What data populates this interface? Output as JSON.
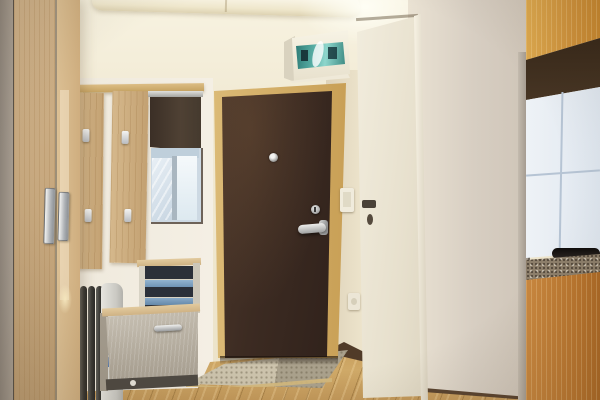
{
  "scene": {
    "description": "Photograph of an apartment entry hallway: dark brown front door with golden wood frame, white fuse box with teal window above left of it, cream interior door on the right, beige walls, kitchenette with orange wood cabinets, dark range hood, white tile backsplash and speckled countertop at far right, light oak wardrobe at far left, wall coat rack boards with metal hooks, cabinet mirror with dark roller blind, small open shelf unit, light grey shoe cabinet, black-and-white oil heater, oak laminate floor with stone threshold mat in front of the door",
    "objects": [
      {
        "name": "front-door",
        "material": "dark brown steel",
        "color": "#3c2b22"
      },
      {
        "name": "front-door-frame",
        "color": "#cfa963"
      },
      {
        "name": "peephole",
        "color": "#c9c9c7"
      },
      {
        "name": "door-handle",
        "color": "#b9bcc0"
      },
      {
        "name": "fuse-box",
        "color": "#f1ecdc",
        "window_color": "#56aca3"
      },
      {
        "name": "interior-door",
        "color": "#eee8d8",
        "handle_color": "#4a4238"
      },
      {
        "name": "light-switch",
        "color": "#f0ebdc"
      },
      {
        "name": "power-outlet",
        "color": "#ece6d6"
      },
      {
        "name": "wardrobe",
        "color": "#c7a77c"
      },
      {
        "name": "coat-rack-boards",
        "color": "#ccae81"
      },
      {
        "name": "mirror",
        "color": "#dfe9f1",
        "blind_color": "#46392d"
      },
      {
        "name": "shelf-unit",
        "interior_color": "#2b3039",
        "shelf_color": "#82a6c4"
      },
      {
        "name": "shoe-cabinet",
        "color": "#b6aea1"
      },
      {
        "name": "oil-heater",
        "fin_color": "#44433f",
        "panel_color": "#d9d8d2"
      },
      {
        "name": "kitchen-upper-cabinet",
        "color": "#d0953f"
      },
      {
        "name": "range-hood",
        "color": "#3f2e1e"
      },
      {
        "name": "backsplash-tiles",
        "color": "#e9eef4"
      },
      {
        "name": "countertop",
        "color": "#897c6a"
      },
      {
        "name": "kitchen-lower-cabinet",
        "color": "#bf7c36"
      },
      {
        "name": "floor",
        "color": "#cba566"
      },
      {
        "name": "threshold-mat",
        "color": "#c3baa3"
      }
    ]
  },
  "palette": {
    "wall_back": "#efe7cf",
    "wall_left": "#f1ece1",
    "wall_right": "#d9d0c4",
    "ceiling": "#f8f3e1",
    "door_brown": "#3c2b22",
    "door_frame": "#cfa963",
    "white_door": "#eee8d8",
    "white_door_handle": "#4a4238",
    "fuse_teal": "#56aca3",
    "wardrobe_wood": "#c7a77c",
    "coat_board": "#ccae81",
    "blind_brown": "#46392d",
    "mirror_glass": "#dfe9f1",
    "shelf_interior": "#2b3039",
    "shelf_blue": "#82a6c4",
    "shoe_cabinet": "#b6aea1",
    "radiator_fins": "#44433f",
    "radiator_label": "#3e6db3",
    "kitchen_upper": "#d0953f",
    "hood": "#3f2e1e",
    "tile": "#e9eef4",
    "countertop": "#897c6a",
    "kitchen_lower": "#bf7c36",
    "floor": "#cba566",
    "threshold": "#c3baa3",
    "baseboard": "#4e3a28"
  }
}
